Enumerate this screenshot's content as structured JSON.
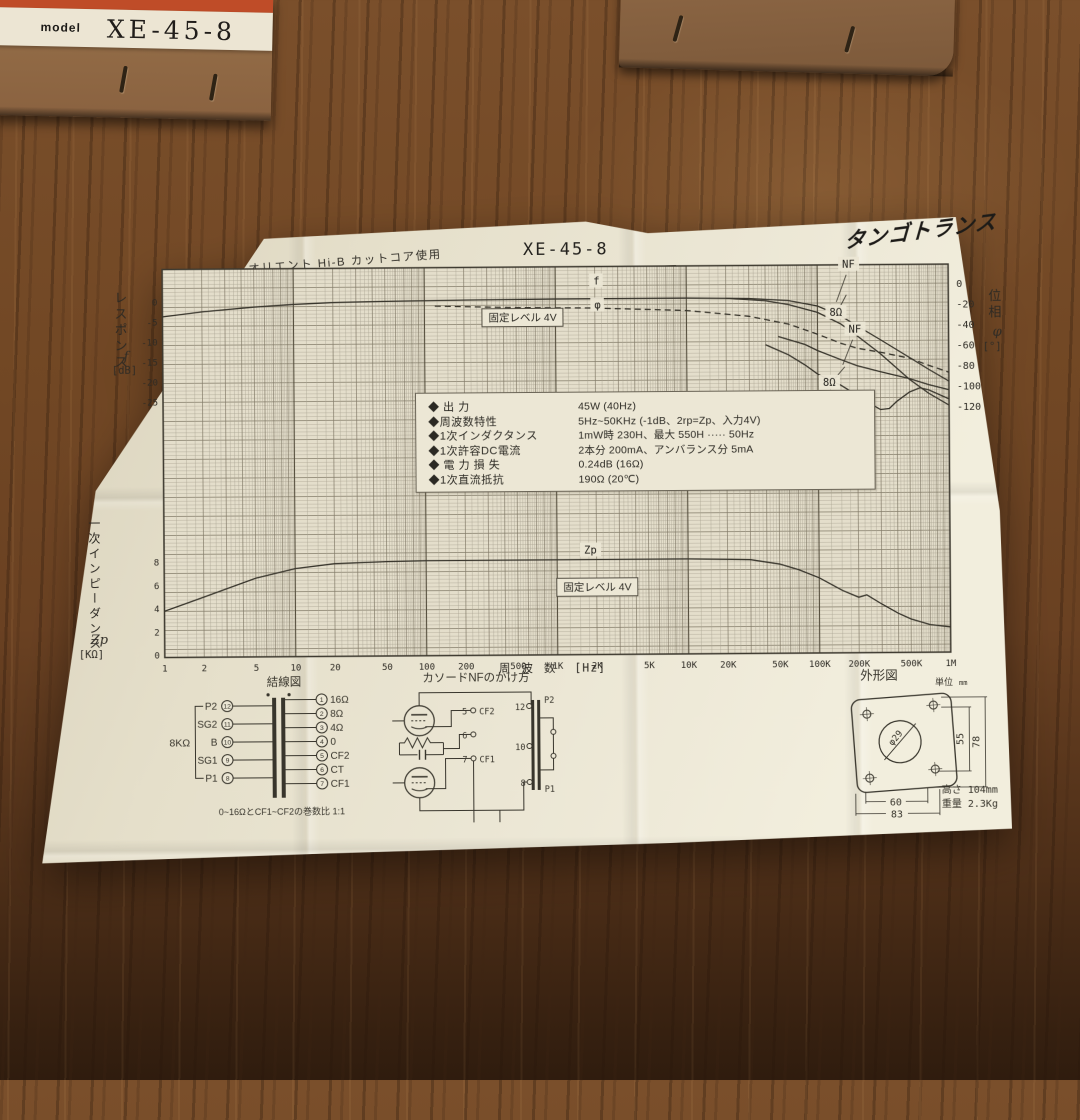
{
  "left_box": {
    "model_label": "model",
    "model_number": "XE-45-8"
  },
  "paper": {
    "header": {
      "core_note": "オリエント Hi-B カットコア使用",
      "title": "XE-45-8",
      "brand": "タンゴトランス"
    },
    "specs": [
      {
        "name": "◆ 出  力",
        "value": "45W (40Hz)"
      },
      {
        "name": "◆周波数特性",
        "value": "5Hz~50KHz (-1dB、2rp=Zp、入力4V)"
      },
      {
        "name": "◆1次インダクタンス",
        "value": "1mW時 230H、最大 550H ····· 50Hz"
      },
      {
        "name": "◆1次許容DC電流",
        "value": "2本分 200mA、アンバランス分 5mA"
      },
      {
        "name": "◆ 電 力 損 失",
        "value": "0.24dB (16Ω)"
      },
      {
        "name": "◆1次直流抵抗",
        "value": "190Ω (20℃)"
      }
    ]
  },
  "chart_data": {
    "type": "line",
    "x_axis": {
      "label": "周波数",
      "unit": "[Hz]",
      "scale": "log",
      "range_hz": [
        1,
        1000000
      ],
      "ticks": [
        "1",
        "2",
        "5",
        "10",
        "20",
        "50",
        "100",
        "200",
        "500",
        "1K",
        "2K",
        "5K",
        "10K",
        "20K",
        "50K",
        "100K",
        "200K",
        "500K",
        "1M"
      ]
    },
    "left_axis_top": {
      "name": "レスポンス",
      "symbol": "f",
      "unit": "[dB]",
      "ticks": [
        0,
        -5,
        -10,
        -15,
        -20,
        -25
      ]
    },
    "right_axis": {
      "name": "位相",
      "symbol": "φ",
      "unit": "[°]",
      "ticks": [
        0,
        -20,
        -40,
        -60,
        -80,
        -100,
        -120
      ]
    },
    "left_axis_bottom": {
      "name": "一次インピーダンス",
      "symbol": "Zp",
      "unit": "[KΩ]",
      "ticks": [
        8,
        6,
        4,
        2,
        0
      ]
    },
    "annotations": {
      "f": "f",
      "phi": "φ",
      "fixed_level": "固定レベル 4V",
      "nf": "NF",
      "ohm_8": "8Ω",
      "zp": "Zp"
    },
    "series": [
      {
        "name": "response-nf",
        "axis": "db",
        "points": [
          [
            1,
            -3.6
          ],
          [
            2,
            -2.4
          ],
          [
            5,
            -1.3
          ],
          [
            10,
            -0.7
          ],
          [
            20,
            -0.3
          ],
          [
            50,
            -0.1
          ],
          [
            200,
            0.1
          ],
          [
            1000,
            0.2
          ],
          [
            10000,
            0.2
          ],
          [
            30000,
            0
          ],
          [
            60000,
            -0.6
          ],
          [
            100000,
            -2
          ],
          [
            150000,
            -4.5
          ],
          [
            200000,
            -7
          ],
          [
            300000,
            -10.5
          ],
          [
            500000,
            -15
          ],
          [
            700000,
            -18
          ],
          [
            1000000,
            -21
          ]
        ]
      },
      {
        "name": "response-8ohm",
        "axis": "db",
        "points": [
          [
            20000,
            0.1
          ],
          [
            40000,
            -0.6
          ],
          [
            60000,
            -1.6
          ],
          [
            100000,
            -3.6
          ],
          [
            150000,
            -6.5
          ],
          [
            200000,
            -9.5
          ],
          [
            300000,
            -14
          ],
          [
            500000,
            -20.5
          ],
          [
            700000,
            -24
          ],
          [
            1000000,
            -27
          ]
        ]
      },
      {
        "name": "phase-main",
        "axis": "phase",
        "dash": true,
        "points": [
          [
            120,
            -18
          ],
          [
            500,
            -20
          ],
          [
            2000,
            -21
          ],
          [
            10000,
            -24
          ],
          [
            30000,
            -30
          ],
          [
            60000,
            -38
          ],
          [
            100000,
            -48
          ],
          [
            150000,
            -57
          ],
          [
            200000,
            -62
          ],
          [
            300000,
            -66
          ],
          [
            500000,
            -72
          ],
          [
            700000,
            -79
          ],
          [
            1000000,
            -86
          ]
        ]
      },
      {
        "name": "phase-nf",
        "axis": "phase",
        "points": [
          [
            50000,
            -50
          ],
          [
            80000,
            -58
          ],
          [
            100000,
            -64
          ],
          [
            150000,
            -73
          ],
          [
            200000,
            -79
          ],
          [
            300000,
            -85
          ],
          [
            500000,
            -92
          ],
          [
            700000,
            -98
          ],
          [
            1000000,
            -103
          ]
        ]
      },
      {
        "name": "phase-8ohm",
        "axis": "phase",
        "points": [
          [
            40000,
            -58
          ],
          [
            60000,
            -68
          ],
          [
            80000,
            -78
          ],
          [
            100000,
            -87
          ],
          [
            150000,
            -98
          ],
          [
            200000,
            -108
          ],
          [
            250000,
            -116
          ],
          [
            300000,
            -122
          ],
          [
            350000,
            -121
          ],
          [
            400000,
            -114
          ],
          [
            500000,
            -105
          ],
          [
            600000,
            -101
          ],
          [
            700000,
            -103
          ],
          [
            1000000,
            -112
          ]
        ]
      },
      {
        "name": "impedance-zp",
        "axis": "zp",
        "points": [
          [
            1,
            3.8
          ],
          [
            2,
            5.0
          ],
          [
            5,
            6.6
          ],
          [
            10,
            7.4
          ],
          [
            20,
            7.8
          ],
          [
            50,
            7.95
          ],
          [
            100,
            8.0
          ],
          [
            1000,
            8.0
          ],
          [
            10000,
            8.0
          ],
          [
            30000,
            7.9
          ],
          [
            50000,
            7.5
          ],
          [
            70000,
            7.0
          ],
          [
            100000,
            6.3
          ],
          [
            150000,
            5.2
          ],
          [
            200000,
            4.6
          ],
          [
            230000,
            4.8
          ],
          [
            300000,
            4.0
          ],
          [
            400000,
            3.2
          ],
          [
            500000,
            2.7
          ],
          [
            700000,
            2.2
          ],
          [
            1000000,
            2.0
          ]
        ]
      }
    ]
  },
  "diagrams": {
    "connection": {
      "title": "結線図",
      "impedance_label": "8KΩ",
      "primary": [
        {
          "name": "P2",
          "pin": "12"
        },
        {
          "name": "SG2",
          "pin": "11"
        },
        {
          "name": "B",
          "pin": "10"
        },
        {
          "name": "SG1",
          "pin": "9"
        },
        {
          "name": "P1",
          "pin": "8"
        }
      ],
      "secondary": [
        {
          "pin": "1",
          "name": "16Ω"
        },
        {
          "pin": "2",
          "name": "8Ω"
        },
        {
          "pin": "3",
          "name": "4Ω"
        },
        {
          "pin": "4",
          "name": "0"
        },
        {
          "pin": "5",
          "name": "CF2"
        },
        {
          "pin": "6",
          "name": "CT"
        },
        {
          "pin": "7",
          "name": "CF1"
        }
      ],
      "note": "0~16ΩとCF1~CF2の巻数比 1:1"
    },
    "cathode_nf": {
      "title": "カソードNFのかけ方",
      "terminals": [
        {
          "pin": "5",
          "name": "CF2"
        },
        {
          "pin": "6",
          "name": ""
        },
        {
          "pin": "7",
          "name": "CF1"
        },
        {
          "pin": "12",
          "name": "P2"
        },
        {
          "pin": "10",
          "name": ""
        },
        {
          "pin": "8",
          "name": "P1"
        }
      ]
    },
    "outline": {
      "title": "外形図",
      "unit_label": "単位",
      "unit_value": "mm",
      "hole": "φ29",
      "inner_v": "55",
      "outer_v": "78",
      "inner_h": "60",
      "outer_h": "83",
      "height_label": "高さ",
      "height_value": "104mm",
      "weight_label": "重量",
      "weight_value": "2.3Kg"
    }
  }
}
